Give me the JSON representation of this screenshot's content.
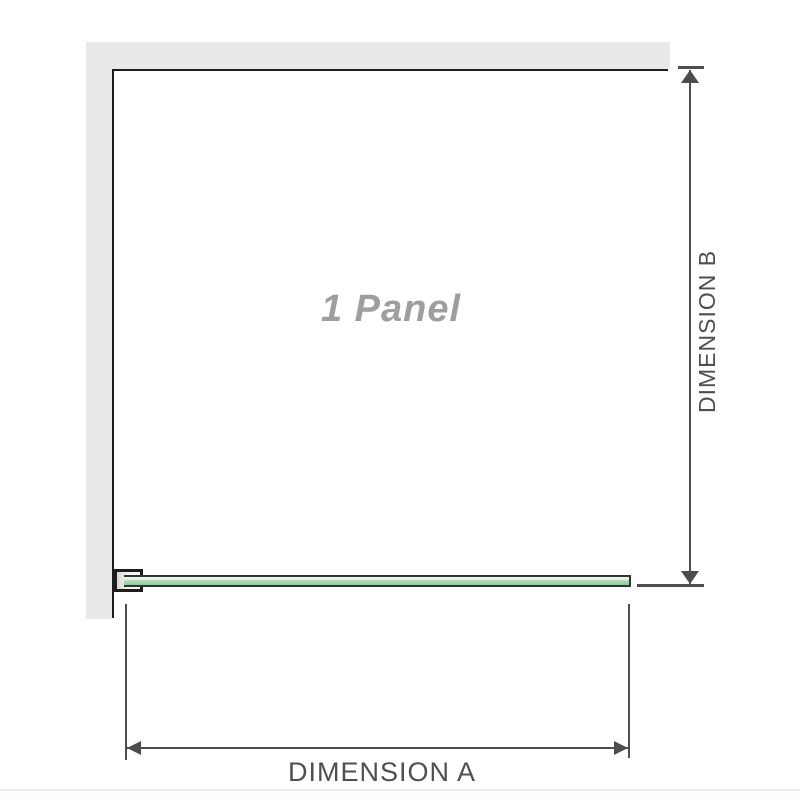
{
  "diagram": {
    "panel_label": "1 Panel",
    "dimension_b": {
      "label": "DIMENSION B",
      "orientation": "vertical",
      "side": "right"
    },
    "dimension_a": {
      "label": "DIMENSION A",
      "orientation": "horizontal",
      "side": "bottom"
    },
    "colors": {
      "wall_fill": "#e9e9e9",
      "outline": "#1d1d1d",
      "dimension_line": "#4d4d4d",
      "label_text": "#4f4f4f",
      "panel_label_text": "#9e9e9e",
      "glass_fill": "#a2d5ac",
      "glass_highlight": "#eaf6ec",
      "glass_edge": "#333333",
      "footer_divider": "#f1ece9"
    }
  }
}
